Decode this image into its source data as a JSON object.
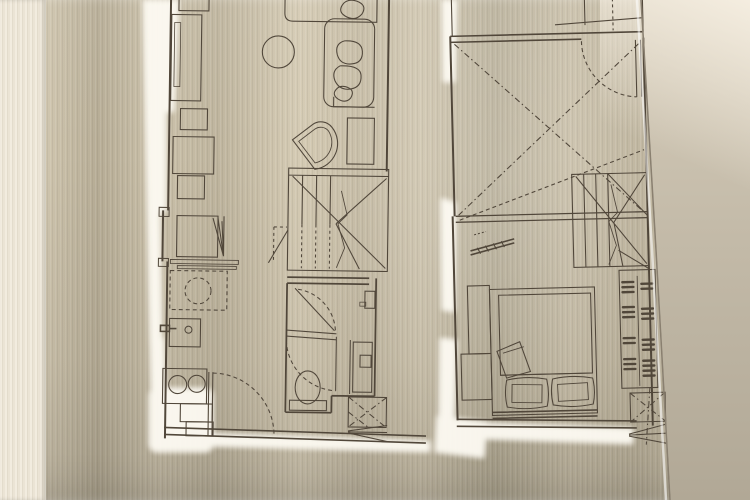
{
  "scene": {
    "kind": "photograph of a brushed-metal plaque engraved with two apartment floor plans",
    "background": "textured wallpaper strip at left, plain wall at right",
    "plans": [
      {
        "id": "lower-level",
        "label": "lower level loft unit plan",
        "fixtures": [
          "console-desk",
          "round-table",
          "sofa-with-cushions",
          "side-table",
          "lounge-chair",
          "dining-table",
          "dining-chairs",
          "desk-with-folding-chair",
          "shelf",
          "washing-machine",
          "kitchen-sink",
          "two-burner-stove",
          "entry-door-swing",
          "winder-staircase",
          "shower-screen",
          "toilet",
          "vanity-basin",
          "ac-unit-with-louver"
        ]
      },
      {
        "id": "upper-level",
        "label": "upper level loft unit plan",
        "fixtures": [
          "balcony-edge",
          "entry-door-swing",
          "double-height-void-cross",
          "guard-railing",
          "wall-ledge-desk",
          "winder-staircase",
          "wardrobe-with-hangers",
          "double-bed",
          "pillows",
          "folded-blanket",
          "nightstand",
          "ac-unit-with-louver"
        ]
      }
    ]
  },
  "colors": {
    "line": "#51473a",
    "cutout_glow": "#fdfaf2",
    "plate_base": "#c6bca5",
    "plate_edge": "#8a8070",
    "wallpaper": "#eee7d9",
    "wall_right": "#c9c0ae",
    "wall_bright": "#ece4d4"
  }
}
